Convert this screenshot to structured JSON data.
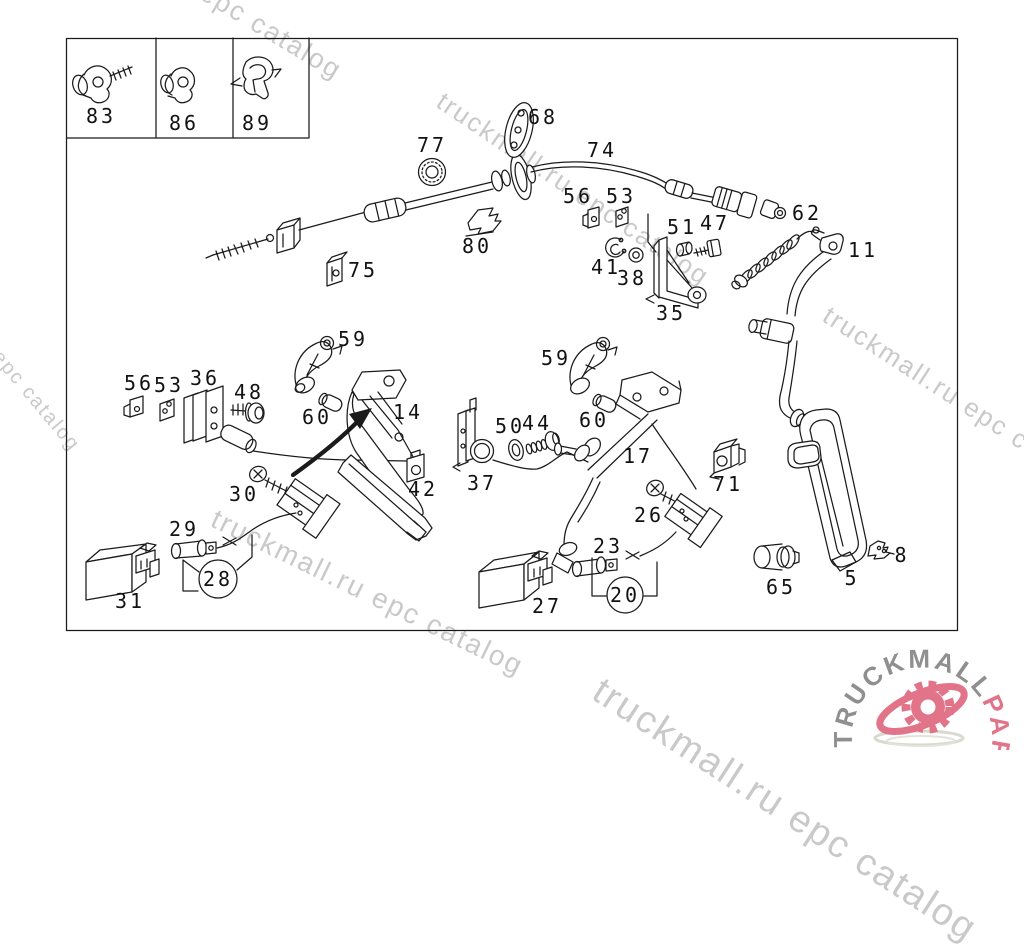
{
  "watermark": {
    "text": "truckmall.ru epc catalog",
    "color": "#c9c9c9"
  },
  "logo": {
    "text_gray": "TRUCKMALL",
    "text_accent": "PARTS",
    "color_gray": "#8f8f8f",
    "color_accent": "#e2748a"
  },
  "diagram": {
    "labels": {
      "p83": "83",
      "p86": "86",
      "p89": "89",
      "p77": "77",
      "p68": "68",
      "p74": "74",
      "p56a": "56",
      "p53a": "53",
      "p51": "51",
      "p47": "47",
      "p62": "62",
      "p11": "11",
      "p41": "41",
      "p38": "38",
      "p35": "35",
      "p80": "80",
      "p75": "75",
      "p59a": "59",
      "p36": "36",
      "p56b": "56",
      "p53b": "53",
      "p48": "48",
      "p60a": "60",
      "p14": "14",
      "p42": "42",
      "p30": "30",
      "p29": "29",
      "p31": "31",
      "p28": "28",
      "p59b": "59",
      "p50": "50",
      "p44": "44",
      "p60b": "60",
      "p37": "37",
      "p17": "17",
      "p71": "71",
      "p26": "26",
      "p23": "23",
      "p27": "27",
      "p20": "20",
      "p65": "65",
      "p5": "5",
      "p8": "8"
    }
  }
}
